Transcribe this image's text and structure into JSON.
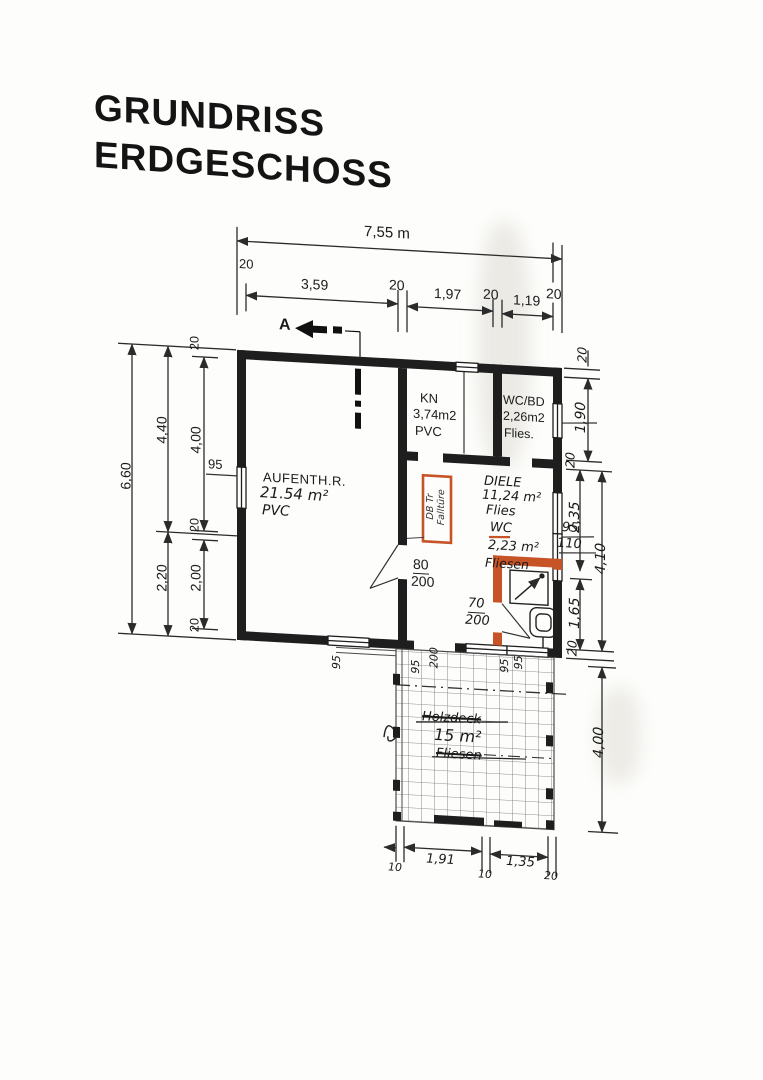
{
  "title": {
    "line1": "GRUNDRISS",
    "line2": "ERDGESCHOSS"
  },
  "section": {
    "label": "A"
  },
  "dims": {
    "top": {
      "overall": "7,55 m",
      "chain": [
        "20",
        "3,59",
        "20",
        "1,97",
        "20",
        "1,19",
        "20"
      ]
    },
    "left": {
      "overall": "6,60",
      "mid": [
        "4,40",
        "2,20"
      ],
      "chain": [
        "20",
        "4,00",
        "20",
        "2,00",
        "20"
      ],
      "window": "95"
    },
    "right": {
      "chain_top": [
        "20",
        "1,90",
        "20"
      ],
      "inner": [
        "2,35",
        "1,65"
      ],
      "outer": "4,10",
      "window_labels": [
        "95",
        "110"
      ],
      "wall_tick": "20",
      "terrace": "4,00"
    },
    "bottom": {
      "chain": [
        "10",
        "1,91",
        "10",
        "1,35",
        "20"
      ]
    }
  },
  "rooms": {
    "main": {
      "name": "AUFENTH.R.",
      "area": "21.54 m²",
      "floor": "PVC"
    },
    "kn": {
      "name": "KN",
      "area": "3,74m2",
      "floor": "PVC"
    },
    "wcbd": {
      "name": "WC/BD",
      "area": "2,26m2",
      "floor": "Flies."
    },
    "diele": {
      "name": "DIELE",
      "area": "11,24 m²",
      "floor": "Flies"
    },
    "wc": {
      "name": "WC",
      "area": "2,23 m²",
      "floor": "Fliesen"
    }
  },
  "terrace": {
    "crossed_label": "Holzdeck",
    "area": "15 m²",
    "floor": "Fliesen"
  },
  "doors": {
    "main_diele": {
      "w": "80",
      "h": "200"
    },
    "wc": {
      "w": "70",
      "h": "200"
    },
    "terrace": {
      "w": "95",
      "h": "200"
    }
  },
  "windows": {
    "terrace": [
      "95",
      "95"
    ],
    "main_bottom": "95"
  },
  "hatch": {
    "line1": "DB Tr",
    "line2": "Falltüre"
  },
  "colors": {
    "wall": "#1e1e1e",
    "accent_orange": "#c65427",
    "line": "#2b2b2b"
  }
}
